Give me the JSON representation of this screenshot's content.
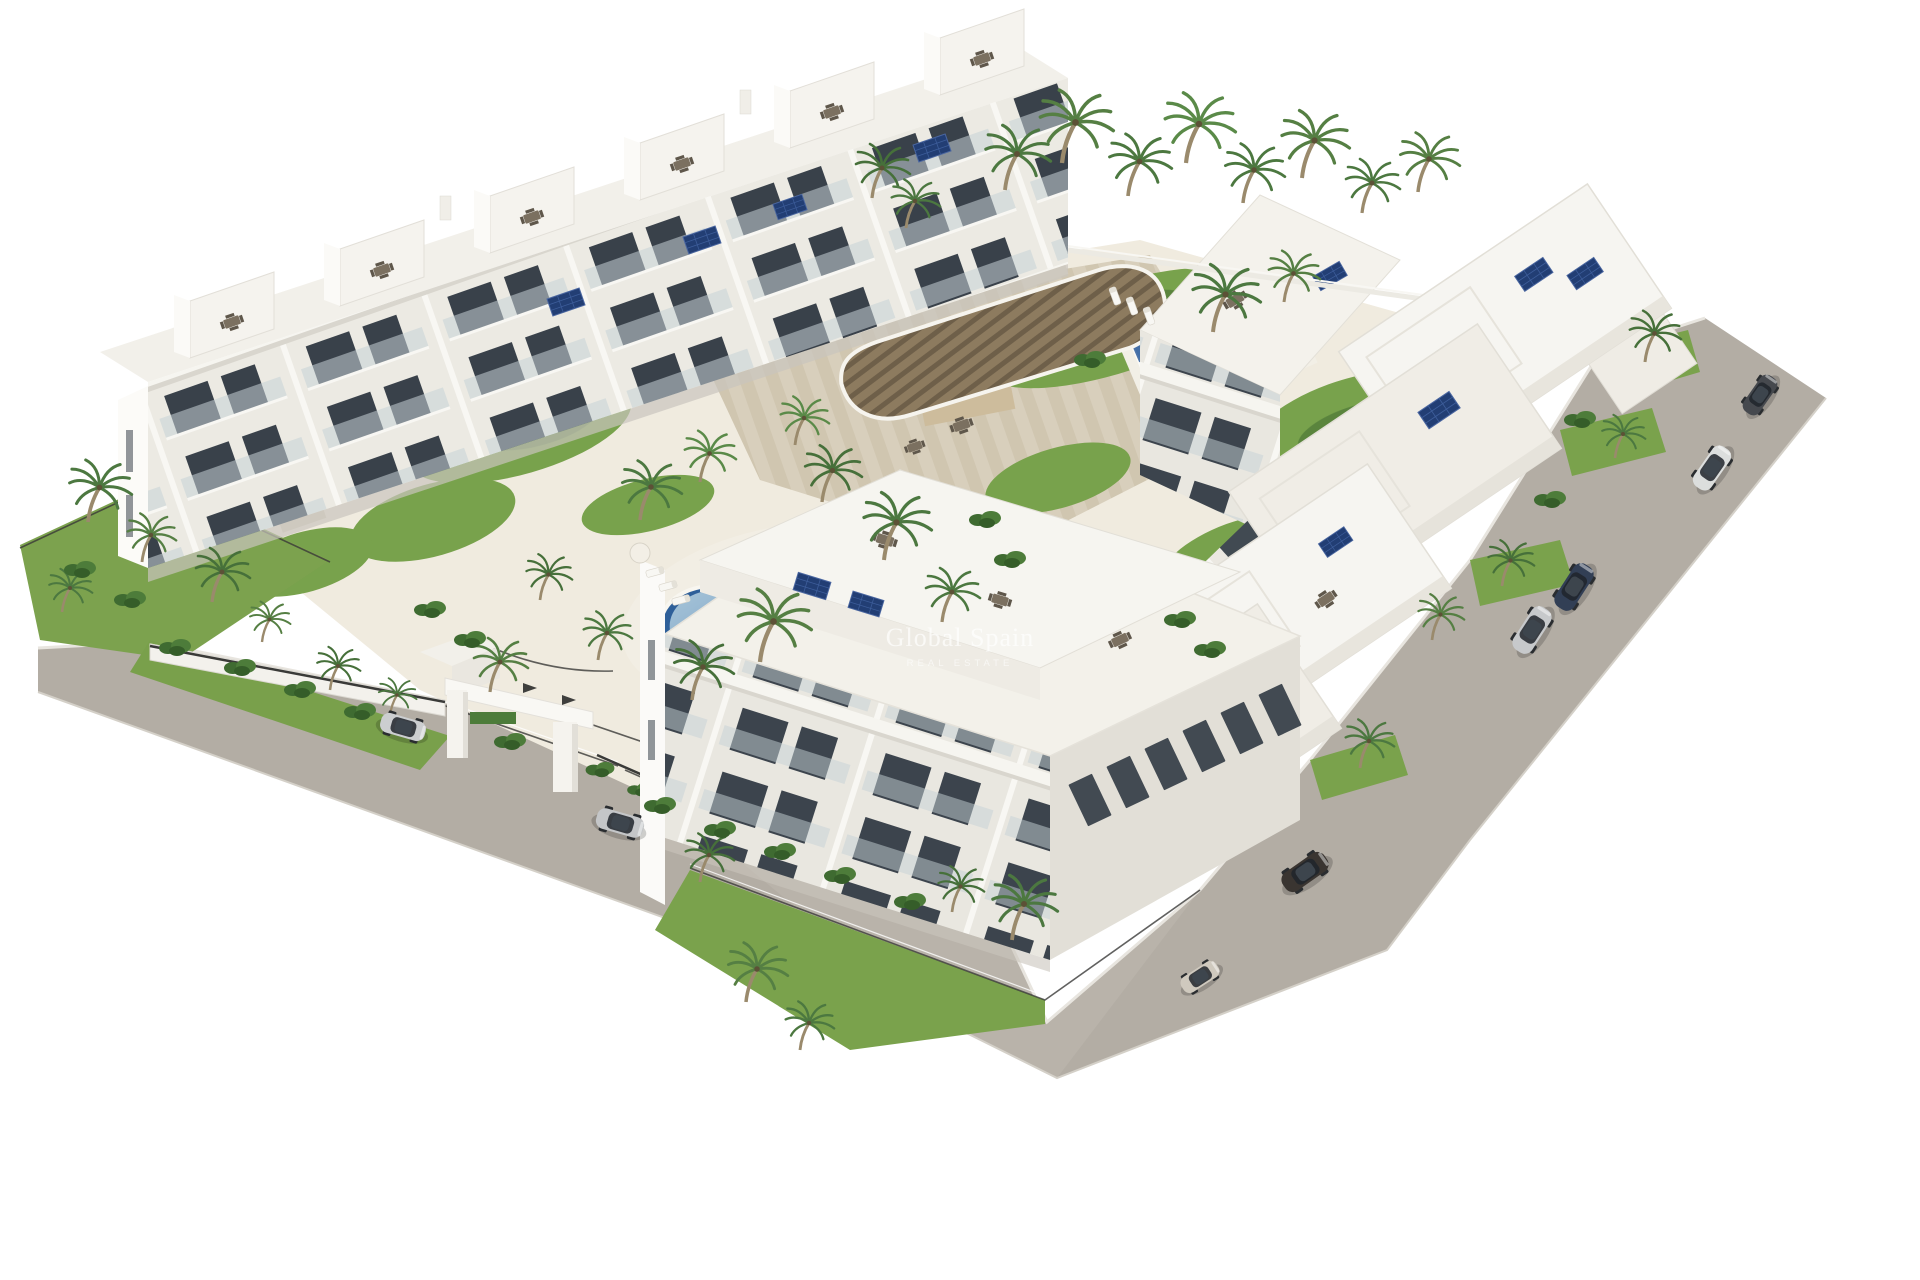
{
  "meta": {
    "type": "3D architectural render",
    "subject": "Aerial isometric view of a white Mediterranean apartment complex with communal pools, palm gardens, timber pergola, perimeter roads and parked cars"
  },
  "watermark": {
    "line1": "Global Spain",
    "line2": "REAL ESTATE"
  },
  "palette": {
    "background": "#ffffff",
    "road": "#b3ada4",
    "road_light": "#beb8af",
    "curb": "#e8e5df",
    "building_white": "#f7f6f2",
    "building_shade": "#e7e4dd",
    "window_dark": "#3c444d",
    "balcony_glass": "#c6d1d6",
    "grass": "#78a24c",
    "foliage_dark": "#46703a",
    "foliage_light": "#6f9c4a",
    "palm_trunk": "#9a8a6c",
    "pool_deck": "#f0ebdf",
    "kidney_pool_water": "#8fb2cd",
    "pool_deep_blue": "#2e5f99",
    "lap_pool_water": "#b4d1e1",
    "sand_paving": "#d8cfbc",
    "pergola_wood": "#8d7b5f",
    "solar_panel": "#223e74",
    "fence_metal": "#3a3a38"
  },
  "scene": {
    "buildings": {
      "back_row_units": 6,
      "right_row_terrace_steps": 5,
      "foreground_blocks": 1,
      "floors_visible": 3,
      "features": [
        "stepped rooftop terraces",
        "rooftop dining sets",
        "solar panels",
        "white balconies",
        "glass garden fences"
      ]
    },
    "pools": [
      {
        "name": "kidney pool",
        "shape": "organic"
      },
      {
        "name": "lap pool",
        "shape": "rectangular"
      }
    ],
    "pergola": {
      "type": "curved timber slat canopy"
    },
    "entrance": {
      "type": "white gate portal with dark logo marks",
      "location": "bottom-left road"
    },
    "vehicles": [
      {
        "id": "car-1",
        "type": "hatchback",
        "color": "#46494e",
        "location": "right road, top"
      },
      {
        "id": "car-2",
        "type": "suv",
        "color": "#dcdedd",
        "location": "right road, top"
      },
      {
        "id": "car-3",
        "type": "sedan",
        "color": "#323f55",
        "location": "right road, middle"
      },
      {
        "id": "car-4",
        "type": "sedan",
        "color": "#c7c9cb",
        "location": "right road, middle"
      },
      {
        "id": "car-5",
        "type": "suv",
        "color": "#3a3531",
        "location": "right road, bottom corner"
      },
      {
        "id": "car-6",
        "type": "city car",
        "color": "#cfc9be",
        "location": "bottom corner"
      },
      {
        "id": "car-7",
        "type": "suv",
        "color": "#ccced0",
        "location": "entrance road"
      },
      {
        "id": "car-8",
        "type": "sedan",
        "color": "#c4c6c8",
        "location": "entrance road"
      }
    ],
    "vegetation": {
      "palm_trees": "30+",
      "lawns": "multiple",
      "hedges": "along fences"
    }
  }
}
